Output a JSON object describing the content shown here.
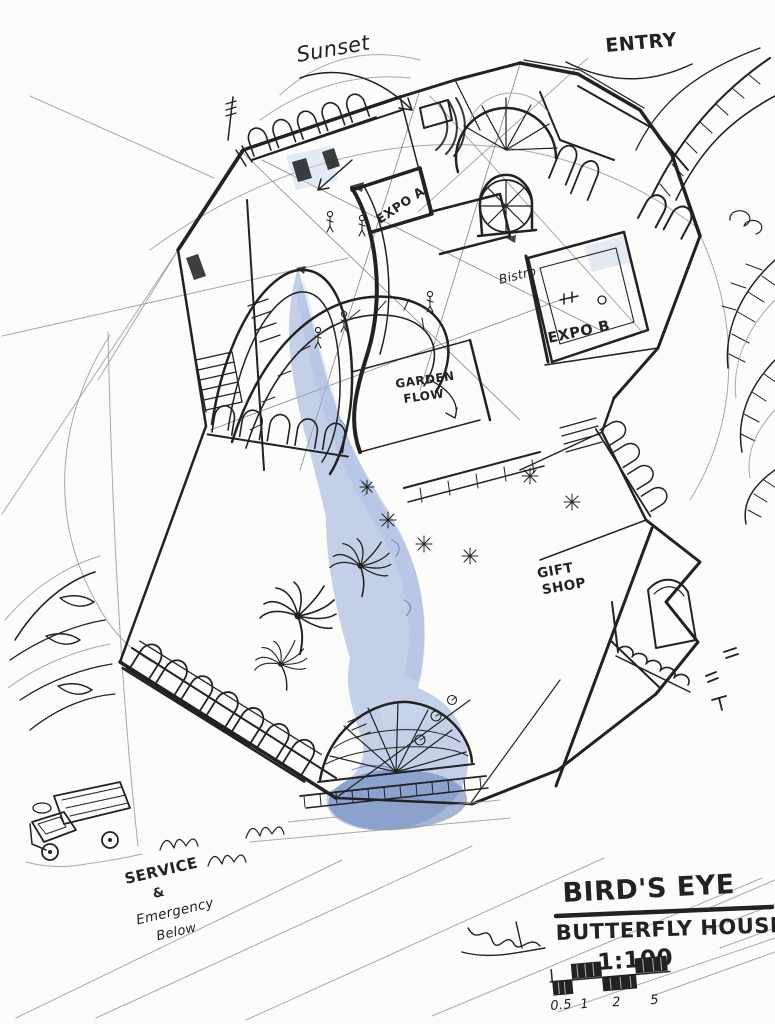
{
  "sketch": {
    "annotations": {
      "sunset": "Sunset",
      "entry": "ENTRY",
      "expo_a": "EXPO A",
      "bistro": "Bistro",
      "expo_b": "EXPO B",
      "garden_flow": {
        "line1": "GARDEN",
        "line2": "FLOW"
      },
      "gift_shop": {
        "line1": "GIFT",
        "line2": "SHOP"
      },
      "service": {
        "line1": "SERVICE",
        "line2": "&",
        "line3": "Emergency",
        "line4": "Below"
      }
    },
    "title_block": {
      "view": "BIRD'S EYE",
      "project": "BUTTERFLY HOUSE",
      "scale": "1:100",
      "scale_bar_ticks": [
        "0.5",
        "1",
        "2",
        "5"
      ]
    },
    "colors": {
      "paper": "#fcfcfa",
      "ink": "#222222",
      "pencil": "#9a9a9a",
      "blue": "#8fa6d6",
      "blue_light": "#c9d7ee",
      "blue_deep": "#5f7cb8"
    }
  }
}
